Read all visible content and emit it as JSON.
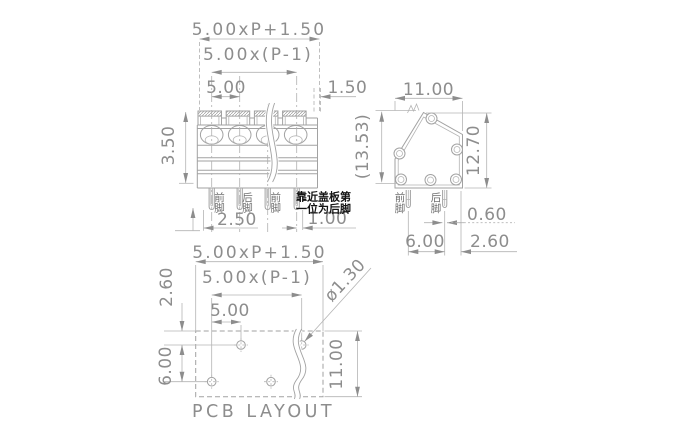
{
  "drawing": {
    "title": "terminal-block dimensional drawing",
    "line_color": "#a2a2a2",
    "text_color": "#8d8d8d",
    "note_color": "#141414",
    "front_view": {
      "dims": {
        "total_width": "5.00xP+1.50",
        "span": "5.00x(P-1)",
        "pitch": "5.00",
        "edge_offset": "1.50",
        "height": "3.50",
        "foot_offset": "2.50",
        "foot_edge": "1.00"
      },
      "pin_labels": [
        "前脚",
        "后脚",
        "前脚"
      ],
      "note_lines": [
        "靠近盖板第",
        "一位为后脚"
      ]
    },
    "side_view": {
      "dims": {
        "width": "11.00",
        "overall_height": "(13.53)",
        "body_height": "12.70",
        "pin_width": "0.60",
        "pin_spacing": "6.00",
        "pin_edge": "2.60"
      },
      "pin_labels": [
        "前脚",
        "后脚"
      ]
    },
    "pcb_layout": {
      "dims": {
        "total_width": "5.00xP+1.50",
        "span": "5.00x(P-1)",
        "pitch": "5.00",
        "row_offset": "2.60",
        "row_spacing": "6.00",
        "board_height": "11.00",
        "hole_dia": "ø1.30"
      },
      "caption": "PCB LAYOUT"
    }
  }
}
